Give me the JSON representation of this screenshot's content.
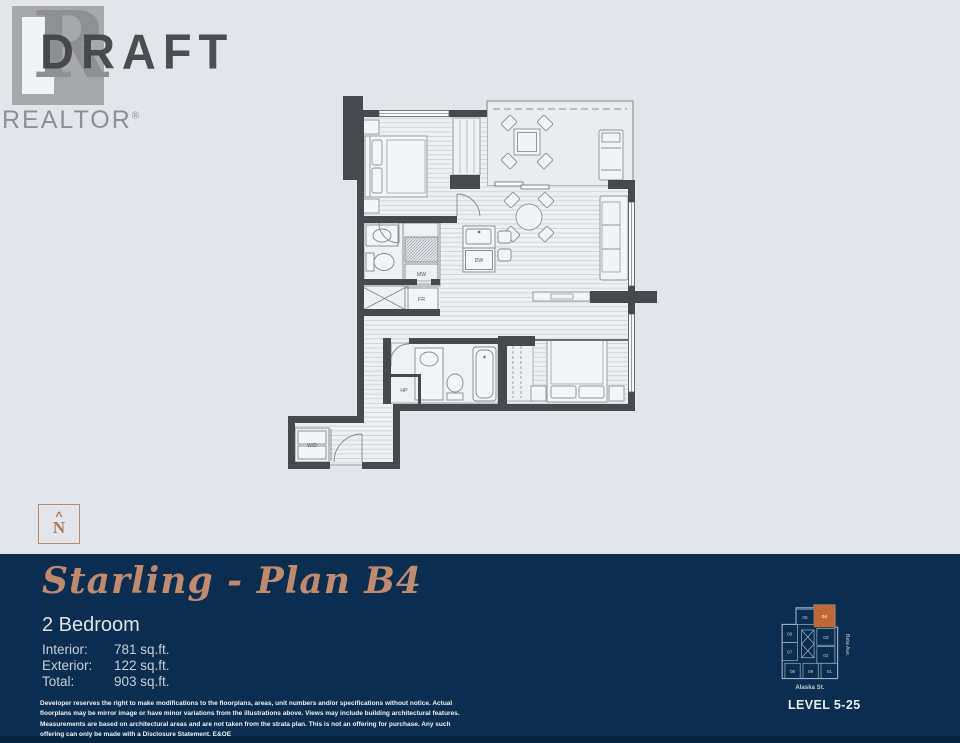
{
  "header": {
    "draft_label": "DRAFT",
    "logo": {
      "letter": "R",
      "label": "REALTOR",
      "registered": "®"
    }
  },
  "north_indicator": {
    "caret": "^",
    "label": "N"
  },
  "floorplan": {
    "labels": {
      "dw": "DW",
      "mw": "MW",
      "fr": "FR",
      "hp": "HP",
      "wd": "W/D"
    }
  },
  "footer": {
    "title": "Starling - Plan B4",
    "subtitle": "2 Bedroom",
    "specs": [
      {
        "label": "Interior:",
        "value": "781 sq.ft."
      },
      {
        "label": "Exterior:",
        "value": "122 sq.ft."
      },
      {
        "label": "Total:",
        "value": "903 sq.ft."
      }
    ],
    "disclaimer": "Developer reserves the right to make modifications to the floorplans, areas, unit numbers and/or specifications without notice. Actual floorplans may be mirror image or have minor variations from the illustrations above. Views may include building architectural features. Measurements are based on architectural areas and are not taken from the strata plan. This is not an offering for purchase. Any such offering can only be made with a Disclosure Statement. E&OE",
    "keyplan": {
      "units": [
        "05",
        "04",
        "06",
        "03",
        "07",
        "02",
        "08",
        "09",
        "01"
      ],
      "highlighted_unit": "04",
      "streets": {
        "right": "Beta Ave.",
        "bottom": "Alaska St."
      },
      "level_label": "LEVEL 5-25"
    },
    "colors": {
      "navy": "#0b2e50",
      "copper": "#c08a6f",
      "highlight_orange": "#c06834"
    }
  }
}
